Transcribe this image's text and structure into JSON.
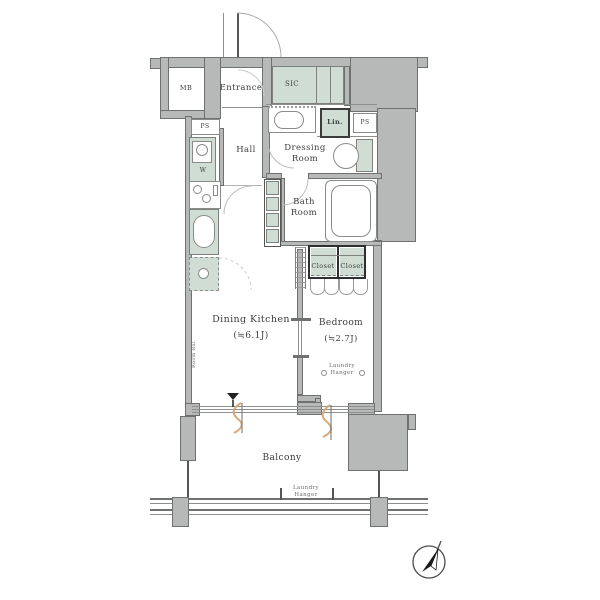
{
  "title": "apartment-floor-plan",
  "colors": {
    "wall_fill": "#b7b9b8",
    "wall_border": "#6f716e",
    "fixture_green": "#cfddd4",
    "curtain_orange": "#d9a977",
    "line_gray": "#8d8f8c",
    "text": "#3b3d3c"
  },
  "rooms": {
    "entrance": {
      "name": "Entrance"
    },
    "hall": {
      "name": "Hall"
    },
    "dressing_room": {
      "name": "Dressing Room"
    },
    "bath_room": {
      "name": "Bath Room"
    },
    "dining_kitchen": {
      "name": "Dining Kitchen",
      "size": "(≒6.1J)"
    },
    "bedroom": {
      "name": "Bedroom",
      "size": "(≒2.7J)"
    },
    "balcony": {
      "name": "Balcony"
    }
  },
  "fixtures": {
    "mb": "MB",
    "sic": "SIC",
    "ps_left": "PS",
    "ps_right": "PS",
    "lin": "Lin.",
    "washer": "W",
    "closet_left": "Closet",
    "closet_right": "Closet",
    "laundry_hanger_bedroom": "Laundry Hanger",
    "laundry_hanger_balcony": "Laundry Hanger",
    "side_wall_label": "Room Bal"
  },
  "compass": {
    "icon": "north-arrow",
    "direction": "NE"
  }
}
